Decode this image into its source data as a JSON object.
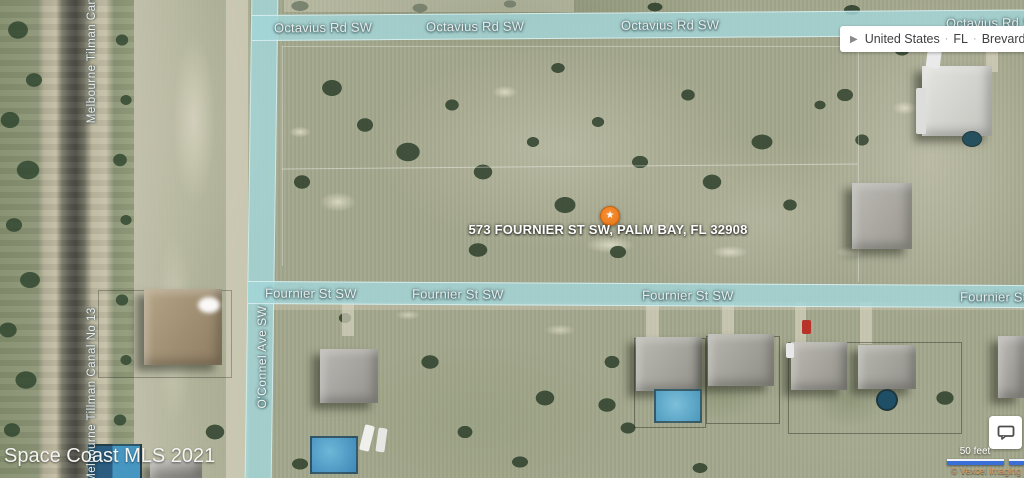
{
  "map": {
    "marker": {
      "icon": "star-icon",
      "glyph": "★",
      "color": "#ee8022",
      "address": "573 FOURNIER ST SW, PALM BAY, FL 32908"
    },
    "watermark": "Space Coast MLS 2021",
    "road_overlay_color": "#a3d5d7",
    "roads": {
      "octavius_labels": [
        "Octavius Rd SW",
        "Octavius Rd SW",
        "Octavius Rd SW",
        "Octavius Rd S"
      ],
      "fournier_labels": [
        "Fournier St SW",
        "Fournier St SW",
        "Fournier St SW",
        "Fournier St S"
      ],
      "oconnel_label": "O'Connel Ave SW",
      "canal_labels": [
        "Melbourne Tilman Cana",
        "Melbourne Tillman Canal No 13"
      ]
    }
  },
  "breadcrumb": {
    "expander_icon": "chevron-right-icon",
    "expander_glyph": "▶",
    "separator": "·",
    "items": [
      "United States",
      "FL",
      "Brevard Co.",
      "Palm"
    ]
  },
  "controls": {
    "feedback_icon": "speech-bubble-icon",
    "scale_label": "50 feet",
    "scalebar_color": "#3a6fd8",
    "attribution": "© Vexcel Imaging"
  }
}
